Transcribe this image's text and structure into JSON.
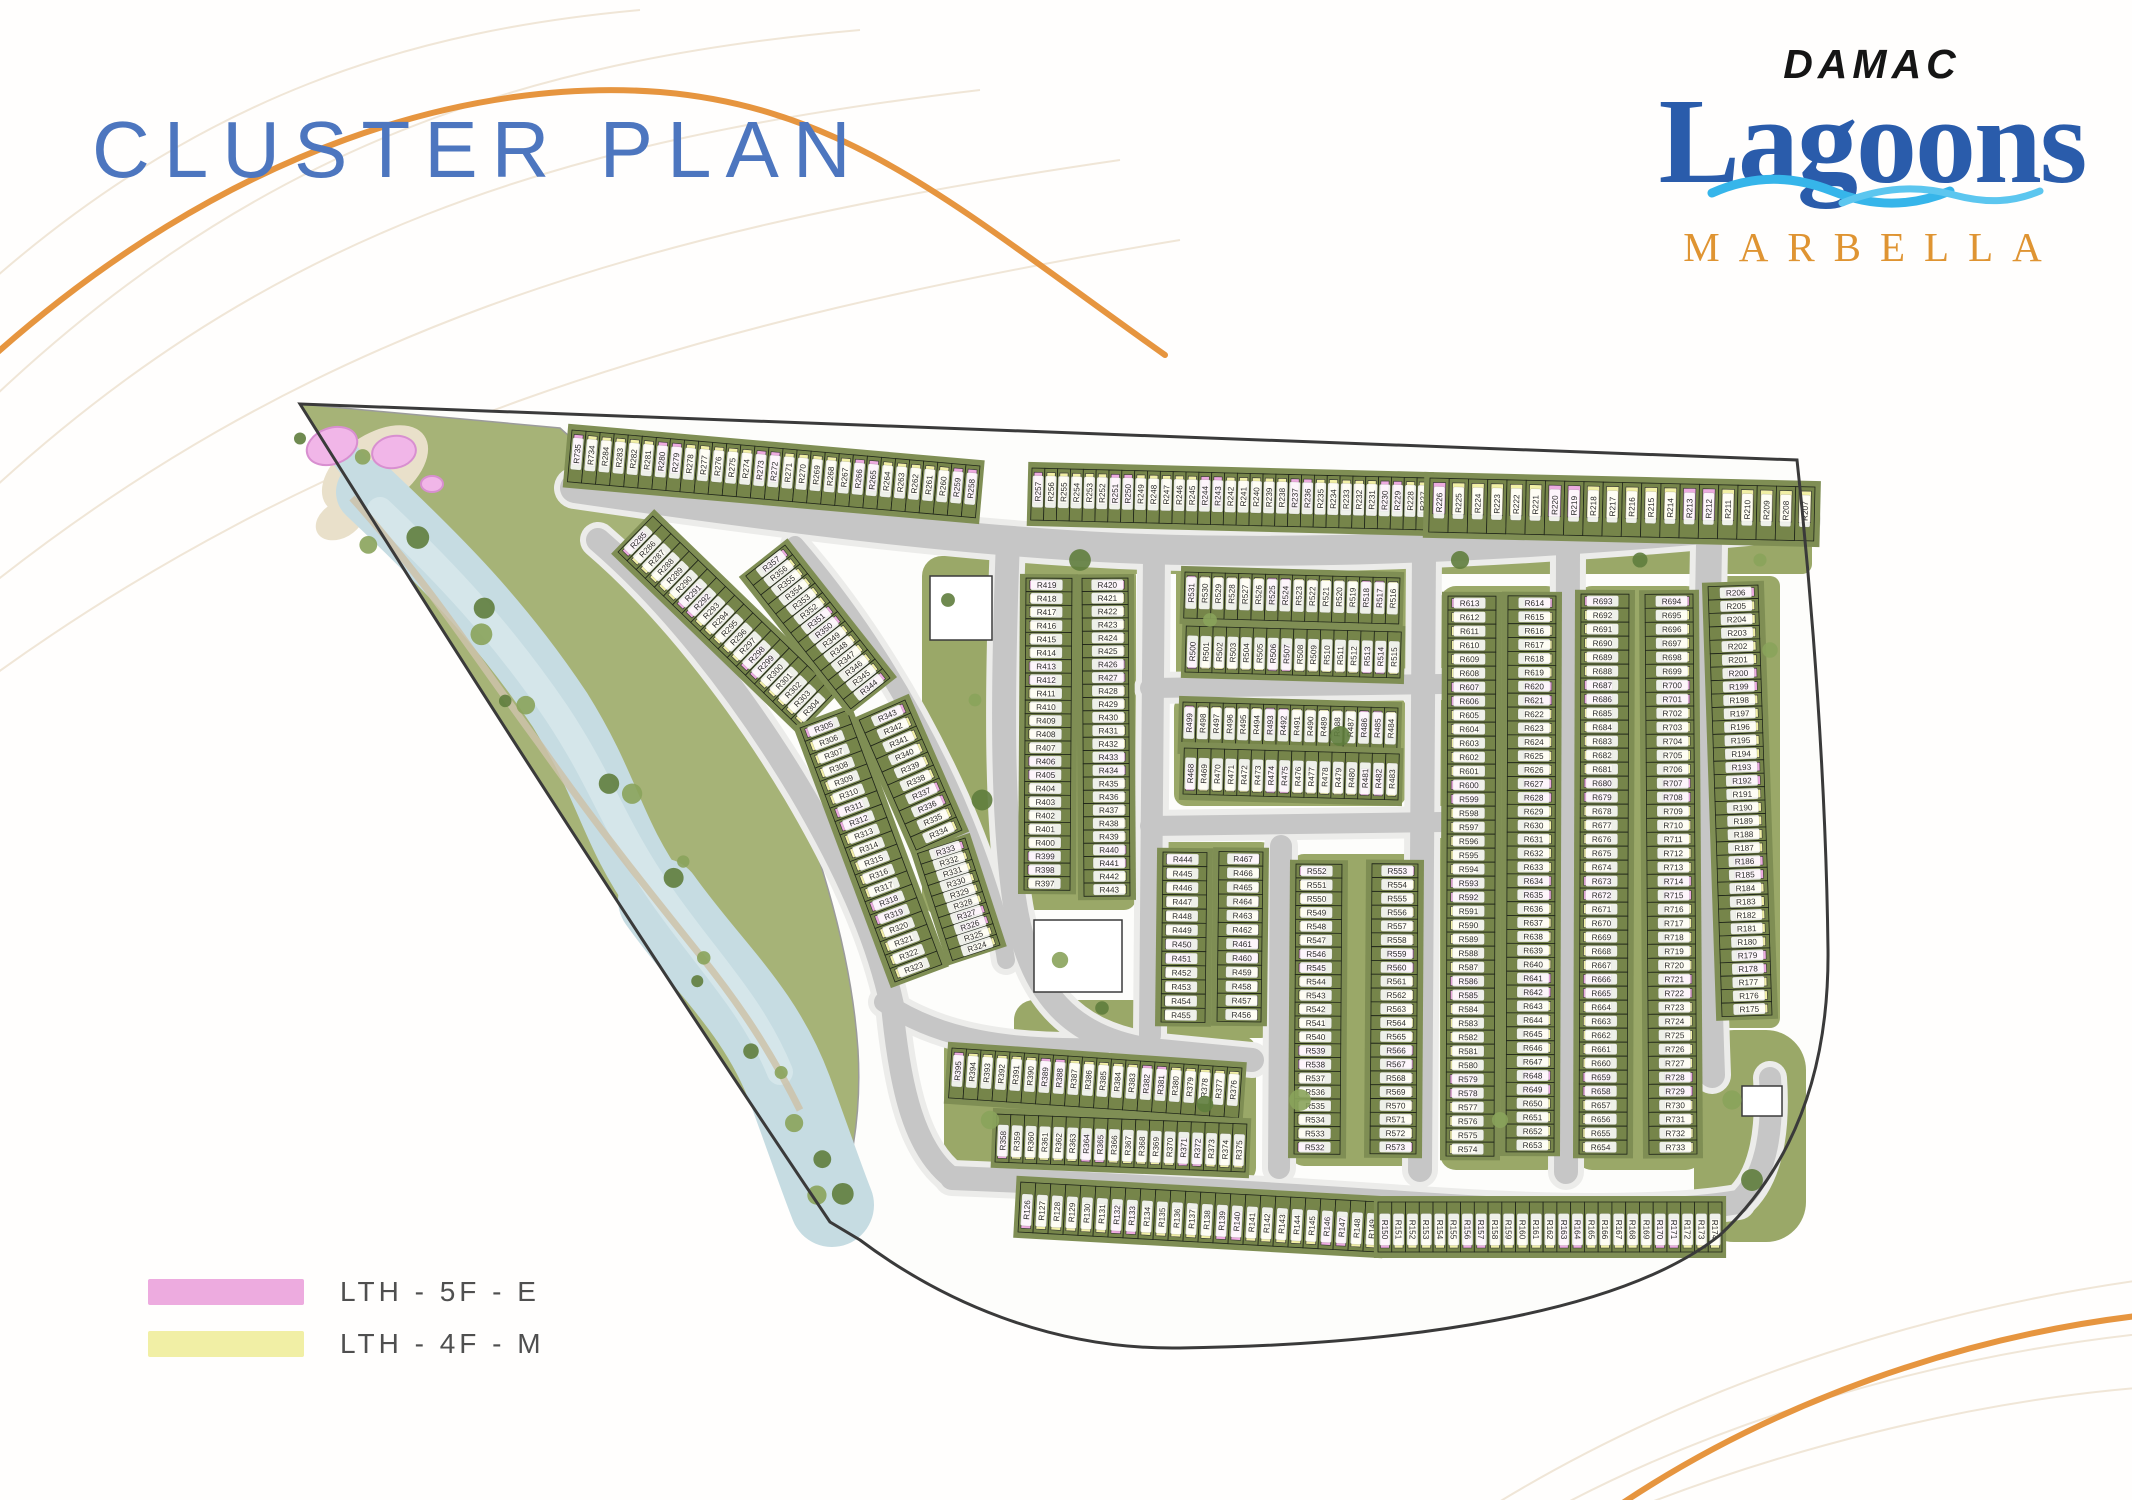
{
  "page": {
    "title": "CLUSTER PLAN"
  },
  "logo": {
    "brand": "DAMAC",
    "name": "Lagoons",
    "community": "MARBELLA"
  },
  "legend": {
    "items": [
      {
        "label": "LTH - 5F - E",
        "color": "#EDABDF"
      },
      {
        "label": "LTH - 4F - M",
        "color": "#F1EFA5"
      }
    ]
  },
  "map": {
    "unit_prefix": "R",
    "colors": {
      "plot": "#76854A",
      "band": "#7F8E54",
      "grass": "#9AA868",
      "road": "#C6C6C6",
      "sidewalk": "#ECECEA",
      "water": "#C6DCE2",
      "water_hi": "#D8E8EC",
      "sand": "#E9E0CA",
      "outline": "#3A3A3A",
      "end_unit": "#EDABDF",
      "mid_unit": "#F1EFA5",
      "label_bg": "#FFFFFF",
      "label_text": "#2B2B2B",
      "tree_dark": "#5F7D3D",
      "tree_light": "#8AA35B",
      "amenity_pink": "#F1B6E8",
      "walkway": "#CDC2A9",
      "contour": "#F0E6D7",
      "accent": "#E6953F"
    },
    "strips": [
      {
        "id": "top-row-west",
        "x1": 572,
        "y1": 430,
        "x2": 980,
        "y2": 466,
        "depth": 52,
        "side": -1,
        "mode": "perp",
        "ranges": [
          [
            735,
            734
          ],
          [
            284,
            258
          ]
        ]
      },
      {
        "id": "top-row-mid",
        "x1": 1032,
        "y1": 468,
        "x2": 1430,
        "y2": 478,
        "depth": 52,
        "side": -1,
        "mode": "perp",
        "ranges": [
          [
            257,
            227
          ]
        ]
      },
      {
        "id": "top-row-east",
        "x1": 1430,
        "y1": 478,
        "x2": 1815,
        "y2": 487,
        "depth": 54,
        "side": -1,
        "mode": "perp",
        "ranges": [
          [
            226,
            207
          ]
        ]
      },
      {
        "id": "col-far-east",
        "x1": 1758,
        "y1": 585,
        "x2": 1772,
        "y2": 1015,
        "depth": 50,
        "side": -1,
        "mode": "along",
        "ranges": [
          [
            206,
            175
          ]
        ]
      },
      {
        "id": "col-east-outer",
        "x1": 1581,
        "y1": 594,
        "x2": 1579,
        "y2": 1154,
        "depth": 48,
        "side": 1,
        "mode": "along",
        "ranges": [
          [
            693,
            654
          ]
        ]
      },
      {
        "id": "col-east-inner",
        "x1": 1693,
        "y1": 594,
        "x2": 1697,
        "y2": 1154,
        "depth": 48,
        "side": -1,
        "mode": "along",
        "ranges": [
          [
            694,
            733
          ]
        ]
      },
      {
        "id": "col-centre-outer",
        "x1": 1448,
        "y1": 596,
        "x2": 1446,
        "y2": 1156,
        "depth": 48,
        "side": 1,
        "mode": "along",
        "ranges": [
          [
            613,
            574
          ]
        ]
      },
      {
        "id": "col-centre-inner",
        "x1": 1556,
        "y1": 596,
        "x2": 1554,
        "y2": 1152,
        "depth": 48,
        "side": -1,
        "mode": "along",
        "ranges": [
          [
            614,
            653
          ]
        ]
      },
      {
        "id": "col-mid-outer",
        "x1": 1296,
        "y1": 864,
        "x2": 1294,
        "y2": 1154,
        "depth": 46,
        "side": 1,
        "mode": "along",
        "ranges": [
          [
            552,
            532
          ]
        ]
      },
      {
        "id": "col-mid-inner",
        "x1": 1418,
        "y1": 864,
        "x2": 1416,
        "y2": 1154,
        "depth": 46,
        "side": -1,
        "mode": "along",
        "ranges": [
          [
            553,
            573
          ]
        ]
      },
      {
        "id": "col-a-outer",
        "x1": 1163,
        "y1": 852,
        "x2": 1161,
        "y2": 1022,
        "depth": 44,
        "side": 1,
        "mode": "along",
        "ranges": [
          [
            444,
            455
          ]
        ]
      },
      {
        "id": "col-a-inner",
        "x1": 1263,
        "y1": 852,
        "x2": 1261,
        "y2": 1022,
        "depth": 44,
        "side": -1,
        "mode": "along",
        "ranges": [
          [
            467,
            456
          ]
        ]
      },
      {
        "id": "col-b-outer",
        "x1": 1026,
        "y1": 578,
        "x2": 1024,
        "y2": 890,
        "depth": 46,
        "side": 1,
        "mode": "along",
        "ranges": [
          [
            419,
            397
          ]
        ]
      },
      {
        "id": "col-b-inner",
        "x1": 1128,
        "y1": 578,
        "x2": 1130,
        "y2": 896,
        "depth": 46,
        "side": -1,
        "mode": "along",
        "ranges": [
          [
            420,
            443
          ]
        ]
      },
      {
        "id": "strip-n-upper",
        "x1": 1185,
        "y1": 572,
        "x2": 1400,
        "y2": 578,
        "depth": 46,
        "side": -1,
        "mode": "perp",
        "ranges": [
          [
            531,
            516
          ]
        ]
      },
      {
        "id": "strip-n-lower",
        "x1": 1185,
        "y1": 672,
        "x2": 1400,
        "y2": 678,
        "depth": 46,
        "side": 1,
        "mode": "perp",
        "ranges": [
          [
            500,
            515
          ]
        ]
      },
      {
        "id": "strip-s-upper",
        "x1": 1183,
        "y1": 702,
        "x2": 1398,
        "y2": 708,
        "depth": 46,
        "side": -1,
        "mode": "perp",
        "ranges": [
          [
            499,
            484
          ]
        ]
      },
      {
        "id": "strip-s-lower",
        "x1": 1183,
        "y1": 794,
        "x2": 1398,
        "y2": 800,
        "depth": 46,
        "side": 1,
        "mode": "perp",
        "ranges": [
          [
            468,
            483
          ]
        ]
      },
      {
        "id": "west-outer-n",
        "x1": 618,
        "y1": 552,
        "x2": 800,
        "y2": 728,
        "depth": 50,
        "side": 1,
        "mode": "perp",
        "ranges": [
          [
            285,
            304
          ]
        ]
      },
      {
        "id": "west-outer-s",
        "x1": 800,
        "y1": 728,
        "x2": 895,
        "y2": 982,
        "depth": 50,
        "side": 1,
        "mode": "perp",
        "ranges": [
          [
            305,
            323
          ]
        ]
      },
      {
        "id": "west-inner-n",
        "x1": 785,
        "y1": 545,
        "x2": 890,
        "y2": 678,
        "depth": 50,
        "side": -1,
        "mode": "perp",
        "ranges": [
          [
            357,
            344
          ]
        ]
      },
      {
        "id": "west-inner-m",
        "x1": 905,
        "y1": 700,
        "x2": 962,
        "y2": 830,
        "depth": 50,
        "side": -1,
        "mode": "perp",
        "ranges": [
          [
            343,
            334
          ]
        ]
      },
      {
        "id": "west-inner-s",
        "x1": 965,
        "y1": 838,
        "x2": 1000,
        "y2": 945,
        "depth": 50,
        "side": -1,
        "mode": "perp",
        "ranges": [
          [
            333,
            324
          ]
        ]
      },
      {
        "id": "southwest-upper",
        "x1": 952,
        "y1": 1048,
        "x2": 1242,
        "y2": 1068,
        "depth": 50,
        "side": -1,
        "mode": "perp",
        "ranges": [
          [
            395,
            376
          ]
        ]
      },
      {
        "id": "southwest-lower",
        "x1": 995,
        "y1": 1162,
        "x2": 1245,
        "y2": 1172,
        "depth": 48,
        "side": 1,
        "mode": "perp",
        "ranges": [
          [
            358,
            375
          ]
        ]
      },
      {
        "id": "south-row-west",
        "x1": 1018,
        "y1": 1232,
        "x2": 1378,
        "y2": 1252,
        "depth": 50,
        "side": 1,
        "mode": "perp",
        "ranges": [
          [
            126,
            149
          ]
        ]
      },
      {
        "id": "south-row-east",
        "x1": 1378,
        "y1": 1252,
        "x2": 1722,
        "y2": 1252,
        "depth": 50,
        "side": 1,
        "mode": "perp",
        "ranges": [
          [
            150,
            174
          ]
        ]
      }
    ]
  }
}
